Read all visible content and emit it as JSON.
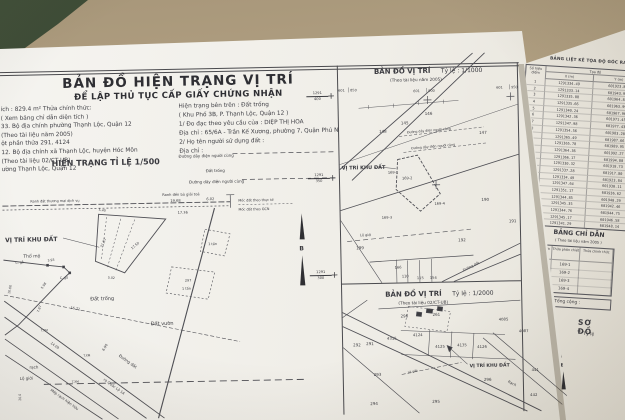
{
  "surface": {
    "color": "#b2a083",
    "dark_object_color": "#2c3626",
    "paper_color": "#f0eee8"
  },
  "main_sheet": {
    "title": "BẢN ĐỒ HIỆN TRẠNG VỊ TRÍ",
    "subtitle": "ĐỂ LẬP THỦ TỤC CẤP GIẤY CHỨNG NHẬN",
    "info_left": [
      "ích : 829.4 m²    Thửa chính thức:",
      "( Xem bảng chỉ dẫn diện tích )",
      "33. Bộ địa chính phường Thạnh Lộc, Quận 12",
      "(Theo tài liệu năm 2005)",
      "ột phần thửa 291, 4124",
      "12. Bộ địa chính xã Thạnh Lộc, huyện Hóc Môn",
      "(Theo tài liệu 02/CT-UB)",
      "ường Thạnh Lộc, Quận 12"
    ],
    "info_right": [
      "Hiện trạng bên trên : Đất trống",
      "( Khu Phố 3B, P. Thạnh Lộc, Quận 12 )",
      "1/ Đo đạc theo yêu cầu của :   DIỆP THỊ HOA",
      "Địa chỉ : 65/6A - Trần Kế Xương, phường 7, Quận Phú Nhuận",
      "2/ Họ tên người sử dụng đất :",
      "Địa chỉ :"
    ],
    "m500": {
      "heading": "HIỆN TRẠNG TỈ LỆ  1/500",
      "labels": {
        "power_line": "Đường dây điện người cùng",
        "clearance": "Ranh đền bù giải toả",
        "commercial": "Ranh đất thương mại dịch vụ",
        "marker_actual": "Mốc đất theo thực tế",
        "marker_gcn": "Mốc đất theo GCN",
        "site": "VỊ TRÍ KHU ĐẤT",
        "tomb": "Thổ mộ",
        "vacant": "Đất trống",
        "garden": "Đất vườn",
        "wood_post": "C. gỗ",
        "house_297": "297",
        "ton_roof": "1 tấn",
        "dirt_road": "Đường đất",
        "to_highway": "ra Quốc Lộ 1A",
        "canal_edge": "Mép rạch hiện hữu",
        "road_limit": "Lộ giới",
        "creek": "rạch",
        "post_marker": "T.XM",
        "north": "B"
      },
      "dims": [
        "19.68",
        "17.36",
        "6.02",
        "21.87",
        "17.50",
        "5.40",
        "5.02",
        "16.71",
        "14.09",
        "7.87",
        "10.00",
        "6.90",
        "5.98",
        "3.93",
        "20.0"
      ]
    },
    "m1000": {
      "title": "BẢN ĐỒ VỊ TRÍ",
      "scale": "Tỷ lệ : 1/1000",
      "source": "(Theo tài liệu năm 2005)",
      "grid_x": [
        [
          "601",
          "850"
        ],
        [
          "601",
          "900"
        ],
        [
          "601",
          "950"
        ]
      ],
      "grid_y": [
        [
          "1291",
          "400"
        ],
        [
          "1291",
          "350"
        ],
        [
          "1291",
          "300"
        ]
      ],
      "parcels": [
        "148",
        "145",
        "146",
        "147",
        "169-1",
        "169-2",
        "169-3",
        "169-4",
        "190",
        "191",
        "192",
        "199",
        "166",
        "110",
        "115",
        "154"
      ],
      "labels": {
        "site": "VỊ TRÍ KHU ĐẤT",
        "power": "Đường dây điện người cùng",
        "road_limit": "Lộ giới",
        "dirt_road": "Đường đất"
      }
    },
    "m2000": {
      "title": "BẢN ĐỒ VỊ TRÍ",
      "scale": "Tỷ lệ : 1/2000",
      "source": "(Theo tài liệu 02/CT-UB)",
      "parcels": [
        "290",
        "261",
        "291",
        "292",
        "4124",
        "4315",
        "4125",
        "4135",
        "4126",
        "4085",
        "4087",
        "293",
        "294",
        "295",
        "296",
        "441",
        "442"
      ],
      "labels": {
        "site": "VỊ TRÍ KHU ĐẤT",
        "creek": "Rạch",
        "road_limit": "Lộ giới",
        "north": "B"
      }
    }
  },
  "right_sheet": {
    "coord_table": {
      "title": "BẢNG LIỆT KÊ TỌA ĐỘ GÓC RANH",
      "col_point": "Số hiệu điểm",
      "col_coords": "Tọa độ",
      "col_x": "X (m)",
      "col_y": "Y (m)",
      "rows": [
        [
          "1",
          "1291334.49",
          "601923.84"
        ],
        [
          "2",
          "1291333.14",
          "601943.99"
        ],
        [
          "3",
          "1291335.88",
          "601964.85"
        ],
        [
          "4",
          "1291335.66",
          "601963.99"
        ],
        [
          "5",
          "1291340.24",
          "601967.96"
        ],
        [
          "6",
          "1291342.36",
          "601971.45"
        ],
        [
          "7",
          "1291347.98",
          "601977.43"
        ],
        [
          "8",
          "1291354.56",
          "601983.20"
        ],
        [
          "9",
          "1291365.49",
          "601987.66"
        ],
        [
          "10",
          "1291365.78",
          "601989.95"
        ],
        [
          "11",
          "1291364.36",
          "601992.27"
        ],
        [
          "12",
          "1291366.17",
          "601994.80"
        ],
        [
          "13",
          "1291330.32",
          "601918.73"
        ],
        [
          "14",
          "1291337.28",
          "601917.80"
        ],
        [
          "15",
          "1291334.49",
          "601923.84"
        ],
        [
          "16",
          "1291347.64",
          "601930.11"
        ],
        [
          "17",
          "1291351.17",
          "601936.62"
        ],
        [
          "18",
          "1291344.85",
          "601940.29"
        ],
        [
          "19",
          "1291345.35",
          "601942.46"
        ],
        [
          "20",
          "1291344.76",
          "601944.75"
        ],
        [
          "21",
          "1291345.17",
          "601946.58"
        ],
        [
          "22",
          "1291341.29",
          "601948.14"
        ]
      ]
    },
    "guide_table": {
      "title": "BẢNG CHỈ DẪN",
      "source": "( Theo tài liệu năm 2005 )",
      "col_parcel": "Số thửa",
      "col_sub": "Thửa phân chiết",
      "col_official": "Thửa chính thức",
      "rows": [
        [
          "169",
          "169-1",
          ""
        ],
        [
          "",
          "169-2",
          ""
        ],
        [
          "",
          "169-3",
          ""
        ],
        [
          "",
          "169-4",
          ""
        ]
      ],
      "total": "Tổng cộng :"
    },
    "diagram_title": "SƠ ĐỒ",
    "diagram_scale": "Tỷ lệ"
  }
}
